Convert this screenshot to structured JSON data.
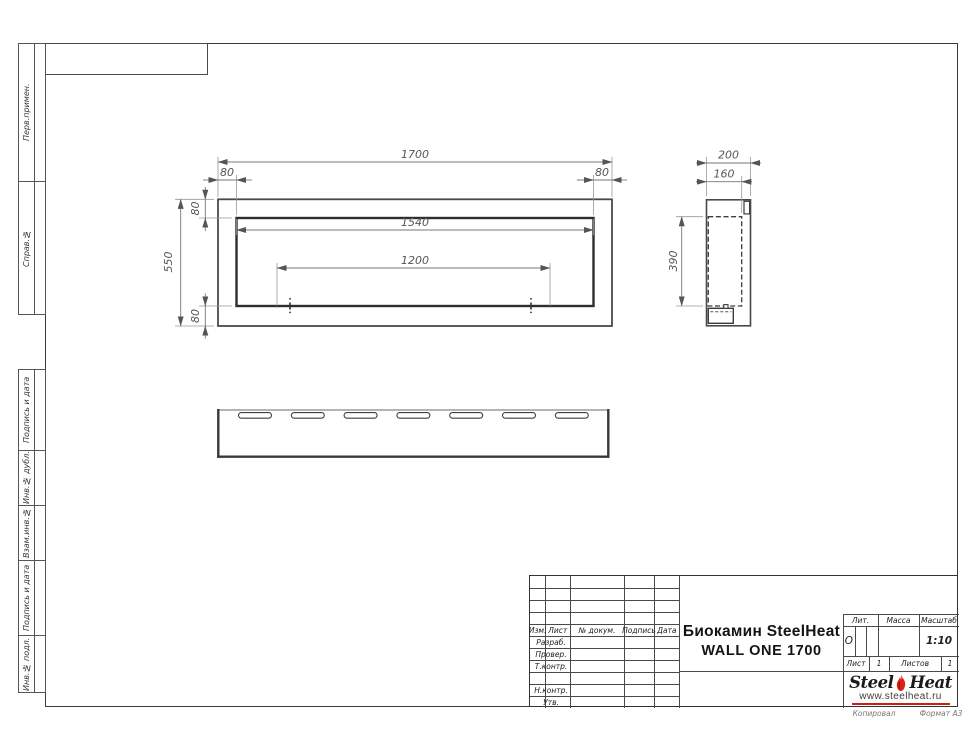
{
  "margin_columns": {
    "top": [
      {
        "label": "Перв.примен."
      },
      {
        "label": "Справ.№"
      }
    ],
    "bottom": [
      {
        "label": "Подпись и дата"
      },
      {
        "label": "Инв.№ дубл."
      },
      {
        "label": "Взам.инв.№"
      },
      {
        "label": "Подпись и дата"
      },
      {
        "label": "Инв.№ подл."
      }
    ]
  },
  "views": {
    "front": {
      "dim_overall_width": "1700",
      "dim_left_offset": "80",
      "dim_right_offset": "80",
      "dim_opening_width": "1540",
      "dim_burner_spacing": "1200",
      "dim_overall_height": "550",
      "dim_top_offset": "80",
      "dim_bottom_offset": "80"
    },
    "side": {
      "dim_depth": "200",
      "dim_inner_depth": "160",
      "dim_inner_height": "390"
    },
    "bottom": {
      "slot_count": 7
    }
  },
  "title_block": {
    "revision_header": {
      "izm": "Изм.",
      "list": "Лист",
      "doc": "№ докум.",
      "sign": "Подпись",
      "date": "Дата"
    },
    "roles": {
      "developed": "Разраб.",
      "checked": "Провер.",
      "tcontrol": "Т.контр.",
      "ncontrol": "Н.контр.",
      "approved": "Утв."
    },
    "title_line1": "Биокамин SteelHeat",
    "title_line2": "WALL ONE 1700",
    "lit_label": "Лит.",
    "lit_value": "О",
    "mass_label": "Масса",
    "scale_label": "Масштаб",
    "scale_value": "1:10",
    "sheet_label": "Лист",
    "sheet_value": "1",
    "sheets_label": "Листов",
    "sheets_value": "1"
  },
  "logo": {
    "steel": "Steel",
    "heat": "Heat",
    "url": "www.steelheat.ru",
    "flame_color": "#e02114",
    "flame_core": "#8f1408",
    "accent": "#cf1d12"
  },
  "footer": {
    "copied": "Копировал",
    "format": "Формат А3"
  }
}
